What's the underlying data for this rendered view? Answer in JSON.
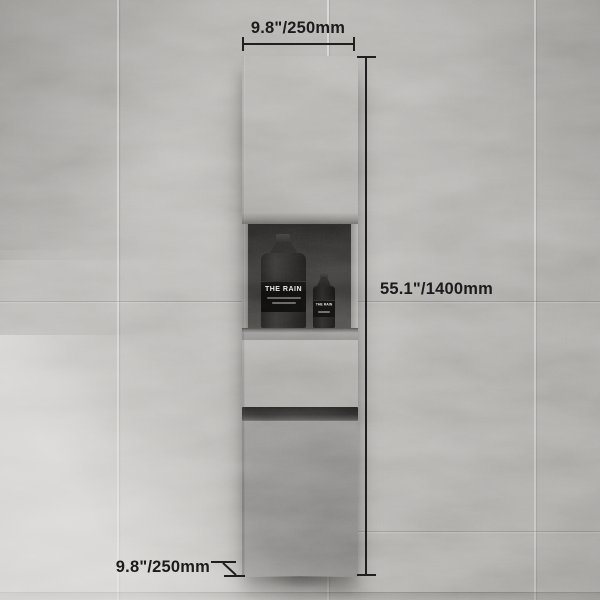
{
  "scene": {
    "annotations": {
      "width": "9.8\"/250mm",
      "height": "55.1\"/1400mm",
      "depth": "9.8\"/250mm"
    },
    "niche_items": {
      "large_bottle_label": "THE RAIN",
      "small_bottle_label": "THE RAIN"
    },
    "colors": {
      "wall": "#b2b0ad",
      "cabinet_light": "#b5b3b0",
      "cabinet_bottom_shadow": "#85837f",
      "niche_interior": "#2e2c2a",
      "handle_groove": "#2f2d2b",
      "annotation_text": "#1b1b1b",
      "bottle": "#1d1c1b",
      "bottle_label_text": "#e9e7e3"
    }
  }
}
